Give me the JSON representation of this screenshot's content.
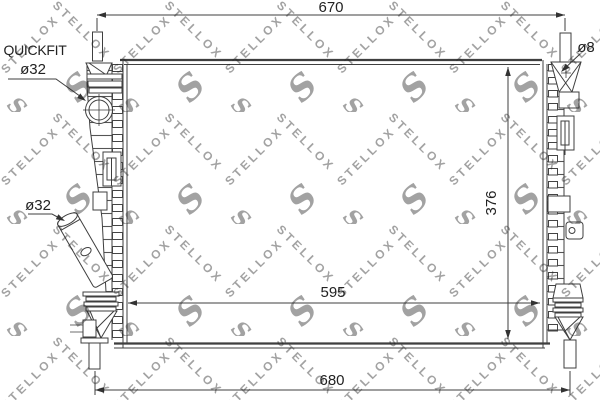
{
  "title": "Radiator technical drawing",
  "dimensions": {
    "top_width": "670",
    "bottom_width": "680",
    "core_width": "595",
    "core_height": "376",
    "pin_diameter": "ø8"
  },
  "labels": {
    "quickfit": "QUICKFIT",
    "quickfit_diameter": "ø32",
    "outlet_diameter": "ø32"
  },
  "watermark": {
    "brand": "STELLOX",
    "logo_letter": "S"
  },
  "colors": {
    "line": "#3f3f3f",
    "text": "#222222",
    "watermark": "#b3b3b3",
    "background": "#ffffff"
  }
}
